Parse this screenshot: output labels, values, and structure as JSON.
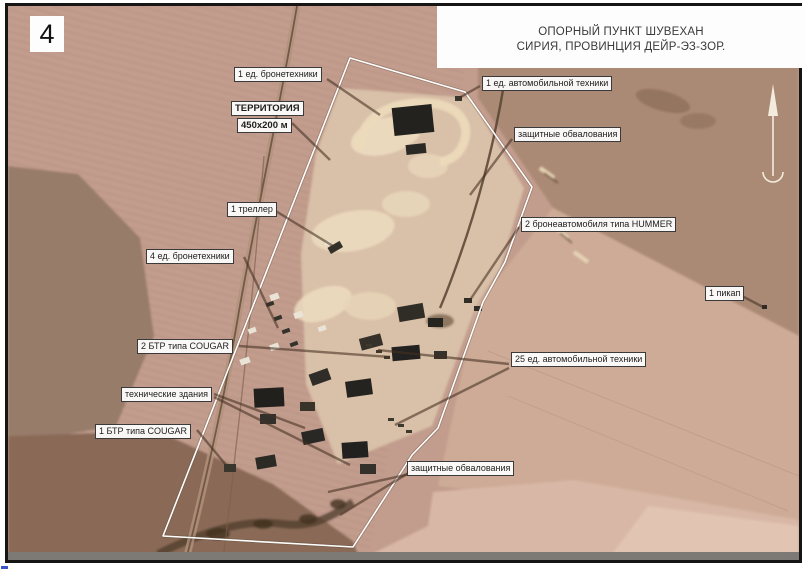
{
  "page_marker": "4",
  "header": {
    "line1": "ОПОРНЫЙ ПУНКТ ШУВЕХАН",
    "line2": "СИРИЯ, ПРОВИНЦИЯ ДЕЙР-ЭЗ-ЗОР."
  },
  "territory_label": {
    "title": "ТЕРРИТОРИЯ",
    "size": "450x200 м"
  },
  "callouts": [
    {
      "label": "1 ед. бронетехники"
    },
    {
      "label": "1 ед. автомобильной техники"
    },
    {
      "label": "защитные обвалования"
    },
    {
      "label": "1 треллер"
    },
    {
      "label": "4 ед. бронетехники"
    },
    {
      "label": "2 бронеавтомобиля типа HUMMER"
    },
    {
      "label": "2 БТР типа COUGAR"
    },
    {
      "label": "25 ед. автомобильной техники"
    },
    {
      "label": "технические здания"
    },
    {
      "label": "1 БТР типа COUGAR"
    },
    {
      "label": "защитные обвалования"
    },
    {
      "label": "1 пикап"
    }
  ],
  "icons": {
    "north_arrow": "compass-north-arrow"
  },
  "colors": {
    "terrain_base": "#c29c8d",
    "terrain_dark_patch": "#957968",
    "compound_bright": "#d9c0a8",
    "perimeter_line": "#ffffff",
    "frame": "#151515"
  }
}
